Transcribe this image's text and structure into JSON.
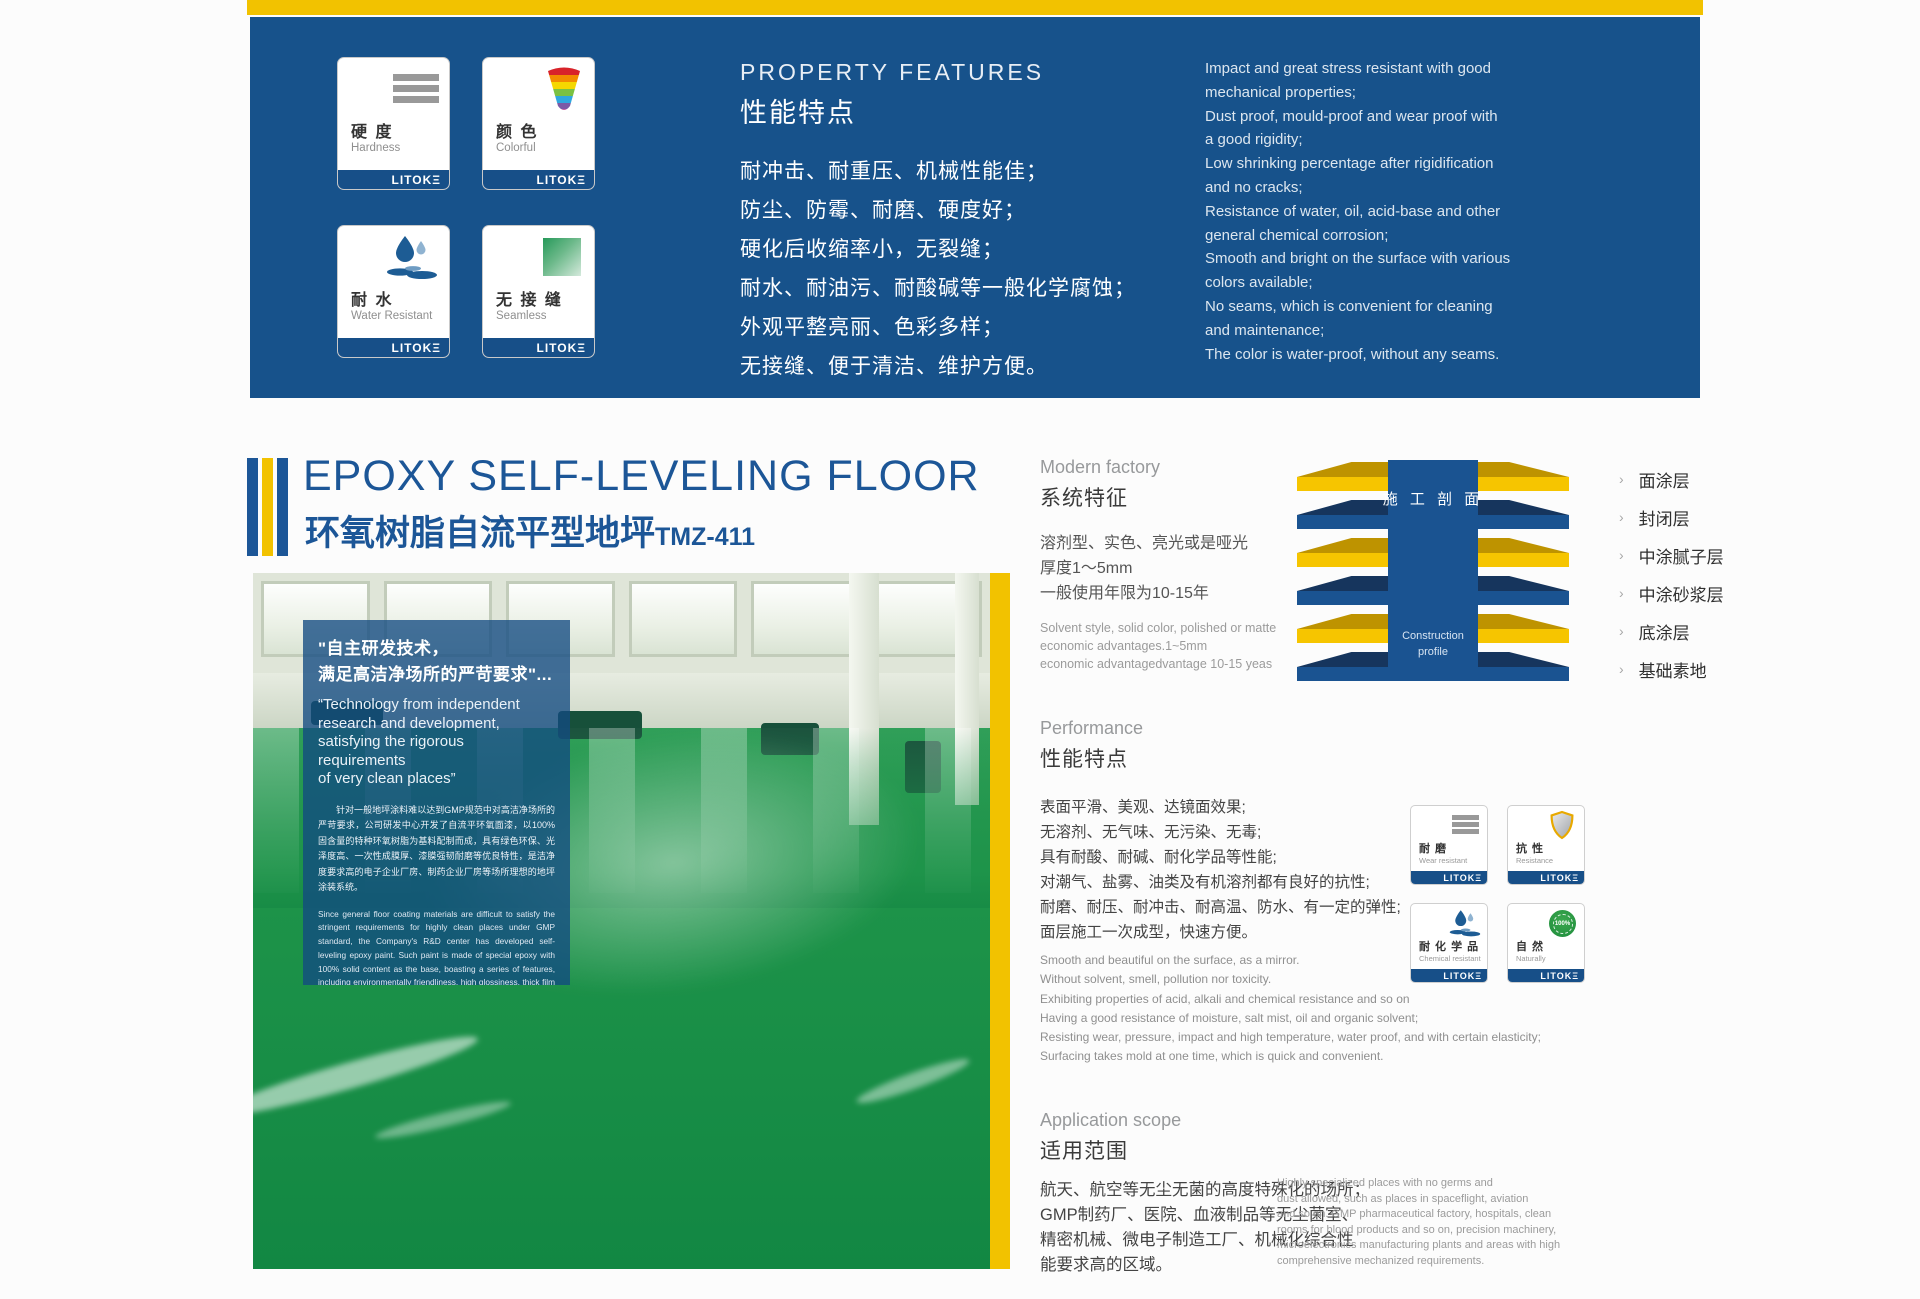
{
  "brand": {
    "logo": "LITOKΞ"
  },
  "colors": {
    "brand_blue": "#17528B",
    "accent_yellow": "#F2C200",
    "title_blue": "#1C5697",
    "floor_green": "#1D9349",
    "footer_bar_blue": "#174F88"
  },
  "top_banner": {
    "heading_en": "PROPERTY FEATURES",
    "heading_zh": "性能特点",
    "cards": [
      {
        "zh": "硬 度",
        "en": "Hardness"
      },
      {
        "zh": "颜 色",
        "en": "Colorful"
      },
      {
        "zh": "耐 水",
        "en": "Water Resistant"
      },
      {
        "zh": "无 接 缝",
        "en": "Seamless"
      }
    ],
    "features_zh": [
      "耐冲击、耐重压、机械性能佳；",
      "防尘、防霉、耐磨、硬度好；",
      "硬化后收缩率小，无裂缝；",
      "耐水、耐油污、耐酸碱等一般化学腐蚀；",
      "外观平整亮丽、色彩多样；",
      "无接缝、便于清洁、维护方便。"
    ],
    "features_en": [
      "Impact and great stress resistant with good",
      "mechanical properties;",
      "Dust proof, mould-proof and wear proof with",
      "a good rigidity;",
      "Low shrinking percentage after rigidification",
      "and no cracks;",
      "Resistance of water, oil, acid-base and other",
      "general chemical corrosion;",
      "Smooth and bright on the surface with various",
      "colors available;",
      "No seams, which is convenient for cleaning",
      "and maintenance;",
      "The color is water-proof, without any seams."
    ]
  },
  "title": {
    "en": "EPOXY SELF-LEVELING FLOOR",
    "zh": "环氧树脂自流平型地坪",
    "model": "TMZ-411"
  },
  "photo_overlay": {
    "quote_zh_1": "\"自主研发技术，",
    "quote_zh_2": "满足高洁净场所的严苛要求\"...",
    "quote_en_lines": [
      "“Technology from independent",
      "research and development,",
      "satisfying the rigorous requirements",
      "of very clean places”"
    ],
    "para_zh": "针对一般地坪涂料难以达到GMP规范中对高洁净场所的严苛要求，公司研发中心开发了自流平环氧面漆，以100%固含量的特种环氧树脂为基料配制而成，具有绿色环保、光泽度高、一次性成膜厚、漆膜强韧耐磨等优良特性，是洁净度要求高的电子企业厂房、制药企业厂房等场所理想的地坪涂装系统。",
    "para_en": "Since general floor coating materials are difficult to satisfy the stringent requirements for highly clean places under GMP standard, the Company's R&D center has developed self-leveling epoxy paint. Such paint is made of special epoxy with 100% solid content as the base, boasting a series of features, including environmentally friendliness, high glossiness, thick film forming, and wear-resistant paint. It certainly becomes the ideal choice for the factories of electronic and medicine manufacturing enterprises."
  },
  "modern_factory": {
    "heading_en": "Modern factory",
    "heading_zh": "系统特征",
    "specs_zh": [
      "溶剂型、实色、亮光或是哑光",
      "厚度1～5mm",
      "一般使用年限为10-15年"
    ],
    "specs_en": [
      "Solvent style, solid color, polished or matte",
      "economic advantages.1~5mm",
      "economic advantagedvantage 10-15  yeas"
    ]
  },
  "construction_profile": {
    "center_zh": "施 工 剖 面",
    "center_en_1": "Construction",
    "center_en_2": "profile",
    "layers": [
      {
        "label": "面涂层",
        "color": "yellow"
      },
      {
        "label": "封闭层",
        "color": "blue"
      },
      {
        "label": "中涂腻子层",
        "color": "yellow"
      },
      {
        "label": "中涂砂浆层",
        "color": "blue"
      },
      {
        "label": "底涂层",
        "color": "yellow"
      },
      {
        "label": "基础素地",
        "color": "blue"
      }
    ]
  },
  "performance": {
    "heading_en": "Performance",
    "heading_zh": "性能特点",
    "bullets_zh": [
      "表面平滑、美观、达镜面效果;",
      "无溶剂、无气味、无污染、无毒;",
      "具有耐酸、耐碱、耐化学品等性能;",
      "对潮气、盐雾、油类及有机溶剂都有良好的抗性;",
      "耐磨、耐压、耐冲击、耐高温、防水、有一定的弹性;",
      "面层施工一次成型，快速方便。"
    ],
    "bullets_en": [
      "Smooth and beautiful on the surface, as a mirror.",
      "Without solvent, smell, pollution nor toxicity.",
      "Exhibiting properties of acid, alkali and chemical resistance and so on",
      "Having a good resistance of moisture, salt mist, oil and organic solvent;",
      "Resisting wear, pressure, impact and high temperature, water proof, and with certain elasticity;",
      "Surfacing takes mold at one time, which is quick and convenient."
    ],
    "cards": [
      {
        "zh": "耐 磨",
        "en": "Wear resistant"
      },
      {
        "zh": "抗 性",
        "en": "Resistance"
      },
      {
        "zh": "耐 化 学 品",
        "en": "Chemical resistant"
      },
      {
        "zh": "自 然",
        "en": "Naturally"
      }
    ]
  },
  "application": {
    "heading_en": "Application scope",
    "heading_zh": "适用范围",
    "zh_lines": [
      "航天、航空等无尘无菌的高度特殊化的场所；",
      "GMP制药厂、医院、血液制品等无尘菌室、",
      "精密机械、微电子制造工厂、机械化综合性",
      "能要求高的区域。"
    ],
    "en_lines": [
      "Highly specialized places with no germs and",
      "dust allowed, such as places in spaceflight, aviation",
      "and so on. GMP pharmaceutical factory, hospitals, clean",
      "rooms for blood products and so on, precision machinery,",
      "microelectronics manufacturing plants and areas with high",
      "comprehensive mechanized requirements."
    ]
  },
  "icons": {
    "eco_badge_text": "100%"
  }
}
